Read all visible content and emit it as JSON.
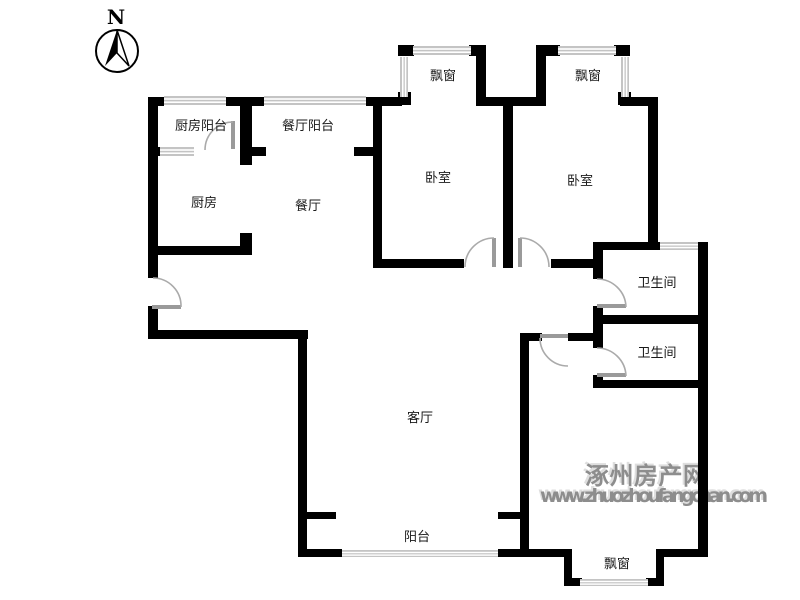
{
  "compass": {
    "north_label": "N"
  },
  "rooms": {
    "kitchen_balcony": "厨房阳台",
    "dining_balcony": "餐厅阳台",
    "bay_window_1": "飘窗",
    "bay_window_2": "飘窗",
    "bedroom_1": "卧室",
    "bedroom_2": "卧室",
    "kitchen": "厨房",
    "dining_room": "餐厅",
    "bathroom_1": "卫生间",
    "bathroom_2": "卫生间",
    "living_room": "客厅",
    "balcony": "阳台",
    "bay_window_bottom": "飘窗"
  },
  "watermark": {
    "site_name": "涿州房产网",
    "site_url": "www.zhuozhoufangchan.com"
  },
  "colors": {
    "wall": "#000000",
    "window_band": "#c4c4c4",
    "door_arc": "#aaaaaa",
    "room_label": "#1a1a1a",
    "watermark": "#8d8d8d",
    "background": "#ffffff"
  }
}
